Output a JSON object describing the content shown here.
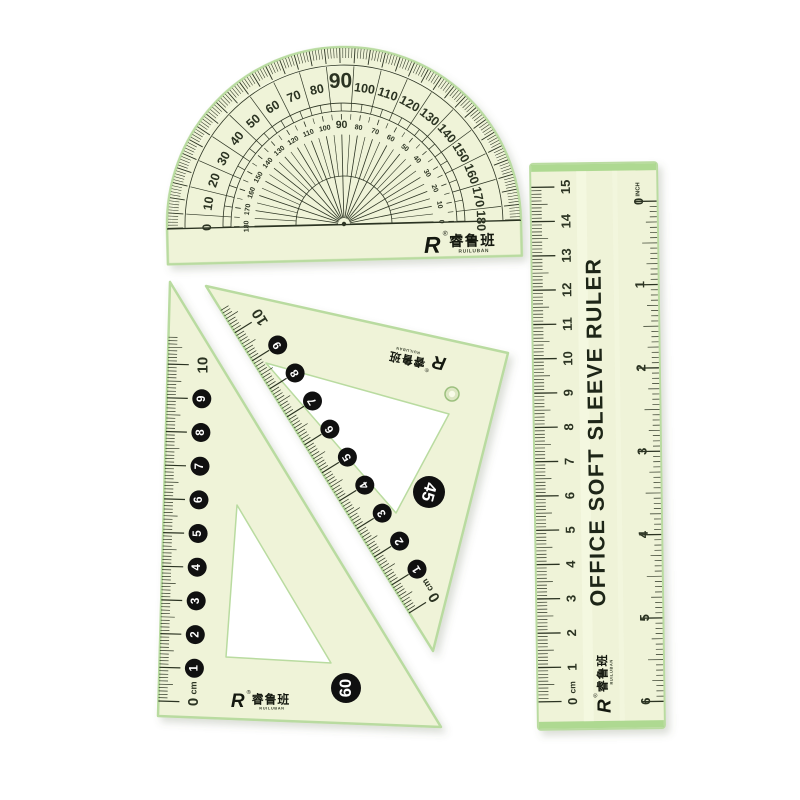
{
  "brand": {
    "logo_letter": "R",
    "registered_mark": "®",
    "name_cn": "睿鲁班",
    "name_en": "RUILUBAN"
  },
  "colors": {
    "body": "#eff3d8",
    "edge": "#b9dba0",
    "bright_edge": "#f8fbe8",
    "marking": "#2b3322",
    "badge_bg": "#101010",
    "badge_text": "#ffffff",
    "green_strip": "#a6d689",
    "white": "#ffffff",
    "hole_fill": "#dde7c3",
    "hole_rim": "#9cc07e",
    "shadow": "#5a6a4a"
  },
  "protractor": {
    "outer_labels": [
      0,
      10,
      20,
      30,
      40,
      50,
      60,
      70,
      80,
      90,
      100,
      110,
      120,
      130,
      140,
      150,
      160,
      170,
      180
    ],
    "inner_labels": [
      180,
      170,
      160,
      150,
      140,
      130,
      120,
      110,
      100,
      90,
      80,
      70,
      60,
      50,
      40,
      30,
      20,
      10,
      0
    ],
    "emphasized_label": 90
  },
  "straight_ruler": {
    "title": "OFFICE SOFT SLEEVE RULER",
    "cm_numbers": [
      0,
      1,
      2,
      3,
      4,
      5,
      6,
      7,
      8,
      9,
      10,
      11,
      12,
      13,
      14,
      15
    ],
    "cm_unit": "cm",
    "inch_numbers": [
      0,
      1,
      2,
      3,
      4,
      5,
      6
    ],
    "inch_unit": "INCH"
  },
  "triangle_60": {
    "corner_label": "60",
    "scale_numbers": [
      0,
      1,
      2,
      3,
      4,
      5,
      6,
      7,
      8,
      9,
      10
    ],
    "unit": "cm"
  },
  "triangle_45": {
    "corner_label": "45",
    "scale_numbers": [
      0,
      1,
      2,
      3,
      4,
      5,
      6,
      7,
      8,
      9,
      10
    ],
    "unit": "cm"
  }
}
